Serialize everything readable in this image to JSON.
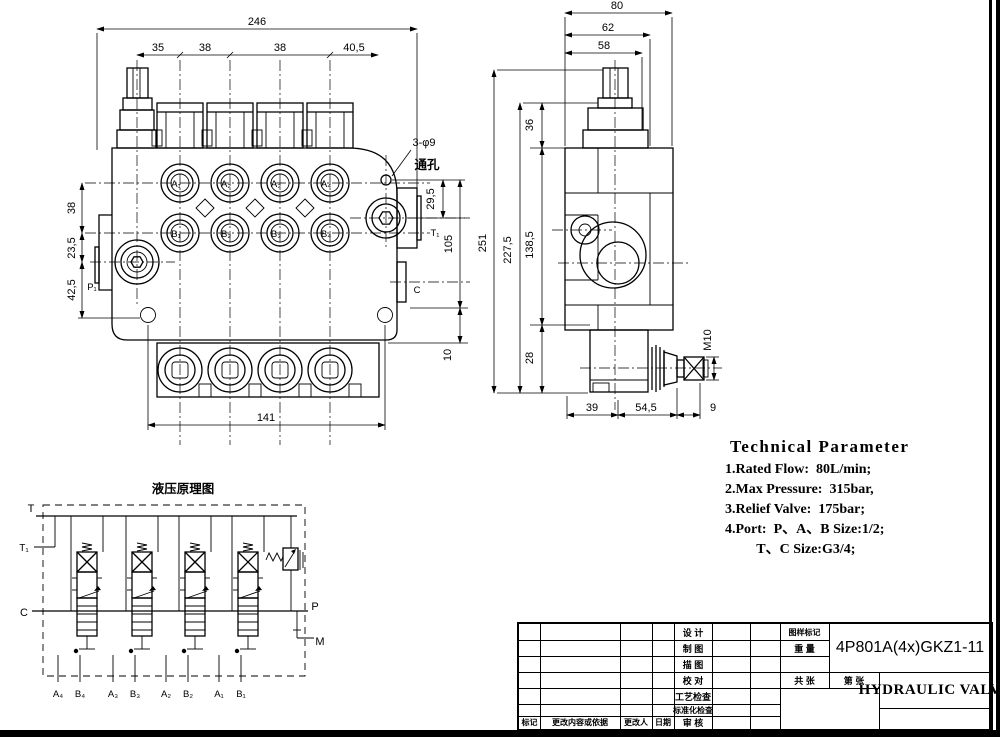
{
  "drawing": {
    "front_view": {
      "dims": {
        "overall_width": "246",
        "pitch1": "35",
        "pitch2": "38",
        "pitch3": "38",
        "pitch4": "40,5",
        "left1": "38",
        "left2": "23,5",
        "left3": "42,5",
        "right1": "29,5",
        "right2": "105",
        "right3": "10",
        "bottom": "141"
      },
      "hole_note": {
        "line1": "3-φ9",
        "line2": "通孔"
      },
      "ports": {
        "a": [
          "A₁",
          "A₂",
          "A₃",
          "A₄"
        ],
        "b": [
          "B₁",
          "B₂",
          "B₃",
          "B₄"
        ],
        "t1": "T₁",
        "c": "C",
        "p1": "P₁"
      }
    },
    "side_view": {
      "dims": {
        "top1": "80",
        "top2": "62",
        "top3": "58",
        "left1": "251",
        "left2": "227,5",
        "left3": "138,5",
        "left4": "36",
        "left5": "28",
        "bottom1": "39",
        "bottom2": "54,5",
        "bottom3": "9",
        "thread": "M10"
      }
    },
    "schematic": {
      "title": "液压原理图",
      "ports": {
        "t": "T",
        "t1": "T₁",
        "c": "C",
        "p": "P",
        "m": "M"
      },
      "work_ports": [
        "A₄",
        "B₄",
        "A₃",
        "B₃",
        "A₂",
        "B₂",
        "A₁",
        "B₁"
      ]
    }
  },
  "technical_parameters": {
    "title": "Technical Parameter",
    "lines": [
      "1.Rated Flow:  80L/min;",
      "2.Max Pressure:  315bar,",
      "3.Relief Valve:  175bar;",
      "4.Port:  P、A、B Size:1/2;",
      "         T、C Size:G3/4;"
    ]
  },
  "title_block": {
    "model": "4P801A(4x)GKZ1-11",
    "product_name": "HYDRAULIC VALVE",
    "process_labels": [
      "设 计",
      "制 图",
      "描 图",
      "校 对",
      "工艺检查",
      "标准化检查",
      "审 核"
    ],
    "revision_labels": [
      "标记",
      "更改内容或依据",
      "更改人",
      "日期"
    ],
    "info_labels": {
      "drawing_mark": "图样标记",
      "weight": "重 量",
      "total_sheets": "共 张",
      "sheet_no": "第 张"
    }
  }
}
